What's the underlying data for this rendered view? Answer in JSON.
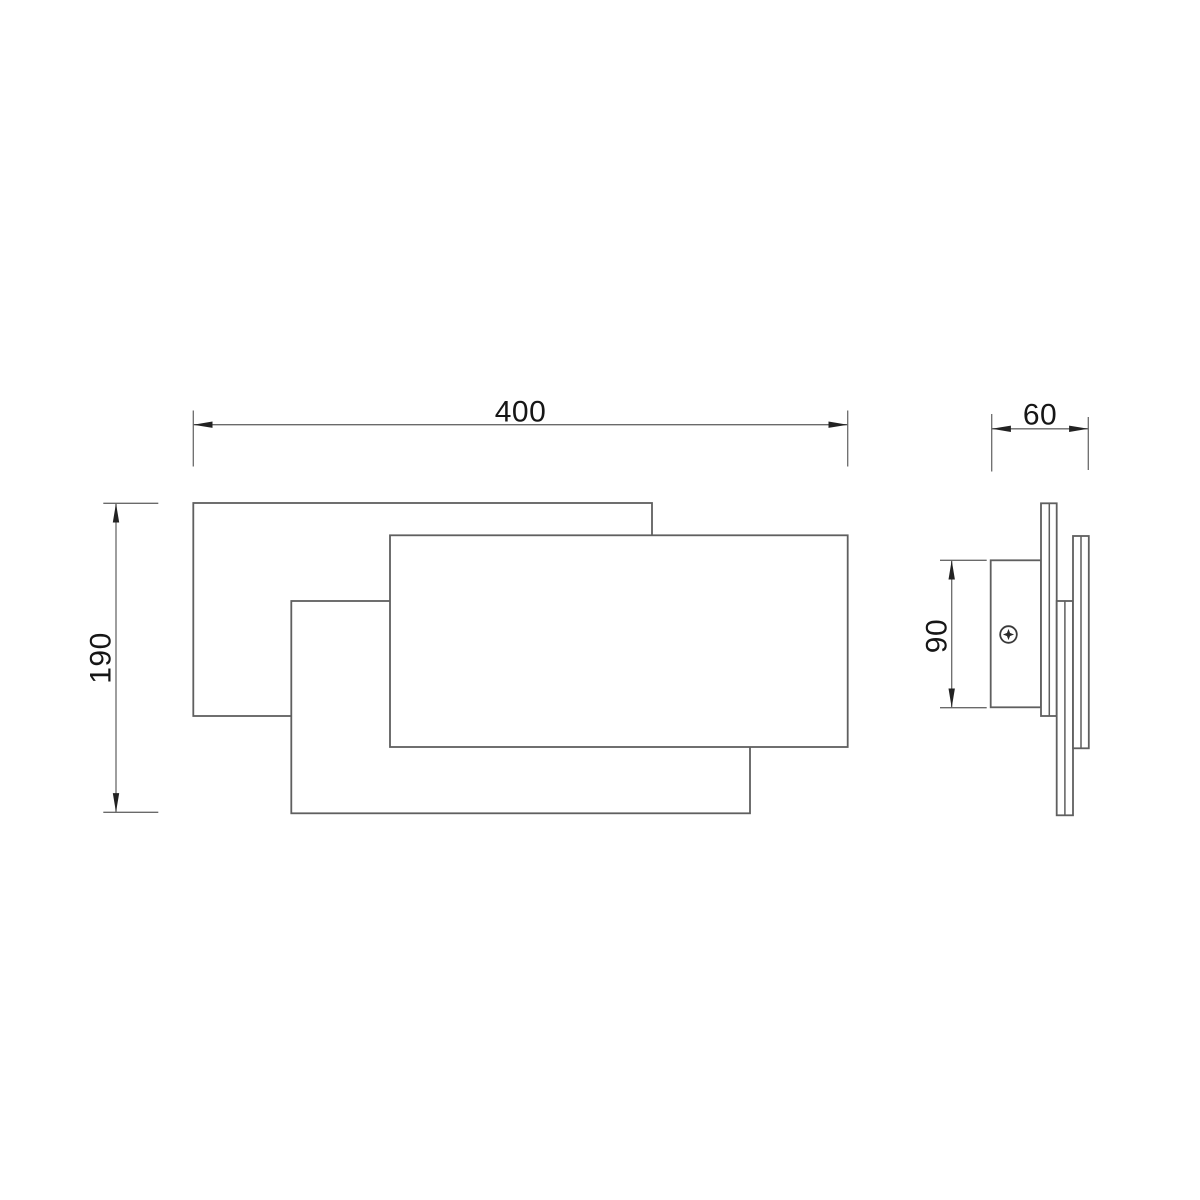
{
  "drawing": {
    "kind": "wall-lamp-technical-drawing",
    "views": {
      "front_view": {
        "name": "front-view",
        "panels": [
          "back-left-panel",
          "bottom-middle-panel",
          "front-right-panel"
        ]
      },
      "side_view": {
        "name": "side-view",
        "parts": [
          "mounting-plate",
          "mounting-screw",
          "back-panel-edge",
          "middle-panel-edge",
          "front-panel-edge"
        ]
      }
    },
    "dimensions": {
      "overall_width": {
        "label": "400"
      },
      "overall_height": {
        "label": "190"
      },
      "overall_depth": {
        "label": "60"
      },
      "bracket_height": {
        "label": "90"
      }
    },
    "colors": {
      "background": "#ffffff",
      "object_line": "#5f5f5f",
      "dimension_line": "#6a6a6a",
      "arrow": "#222222",
      "text": "#161616"
    }
  }
}
